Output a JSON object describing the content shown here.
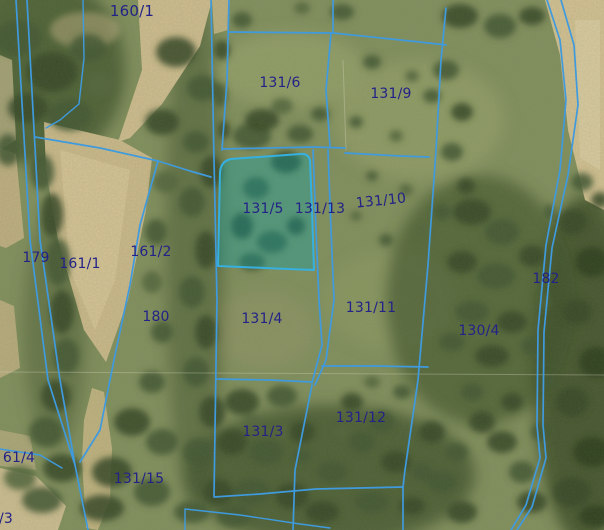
{
  "map": {
    "selected_parcel": {
      "label": "131/5"
    },
    "colors": {
      "boundary_line": "#3f9ade",
      "selected_fill": "#00a5af",
      "selected_stroke": "#35b0e0",
      "label_text": "#232287"
    },
    "labels": [
      {
        "label": "160/1",
        "x": 132,
        "y": 11,
        "big": true
      },
      {
        "label": "131/6",
        "x": 280,
        "y": 83
      },
      {
        "label": "131/9",
        "x": 391,
        "y": 94
      },
      {
        "label": "131/5",
        "x": 263,
        "y": 209,
        "selected": true
      },
      {
        "label": "131/13",
        "x": 320,
        "y": 209
      },
      {
        "label": "131/10",
        "x": 381,
        "y": 201,
        "tilt": true
      },
      {
        "label": "179",
        "x": 36,
        "y": 258
      },
      {
        "label": "161/1",
        "x": 80,
        "y": 264
      },
      {
        "label": "161/2",
        "x": 151,
        "y": 252
      },
      {
        "label": "180",
        "x": 156,
        "y": 317
      },
      {
        "label": "182",
        "x": 546,
        "y": 279
      },
      {
        "label": "130/4",
        "x": 479,
        "y": 331
      },
      {
        "label": "131/4",
        "x": 262,
        "y": 319
      },
      {
        "label": "131/11",
        "x": 371,
        "y": 308
      },
      {
        "label": "131/3",
        "x": 263,
        "y": 432
      },
      {
        "label": "131/12",
        "x": 361,
        "y": 418
      },
      {
        "label": "61/4",
        "x": 19,
        "y": 458
      },
      {
        "label": "131/15",
        "x": 139,
        "y": 479
      },
      {
        "label": "/3",
        "x": 6,
        "y": 519
      }
    ]
  }
}
